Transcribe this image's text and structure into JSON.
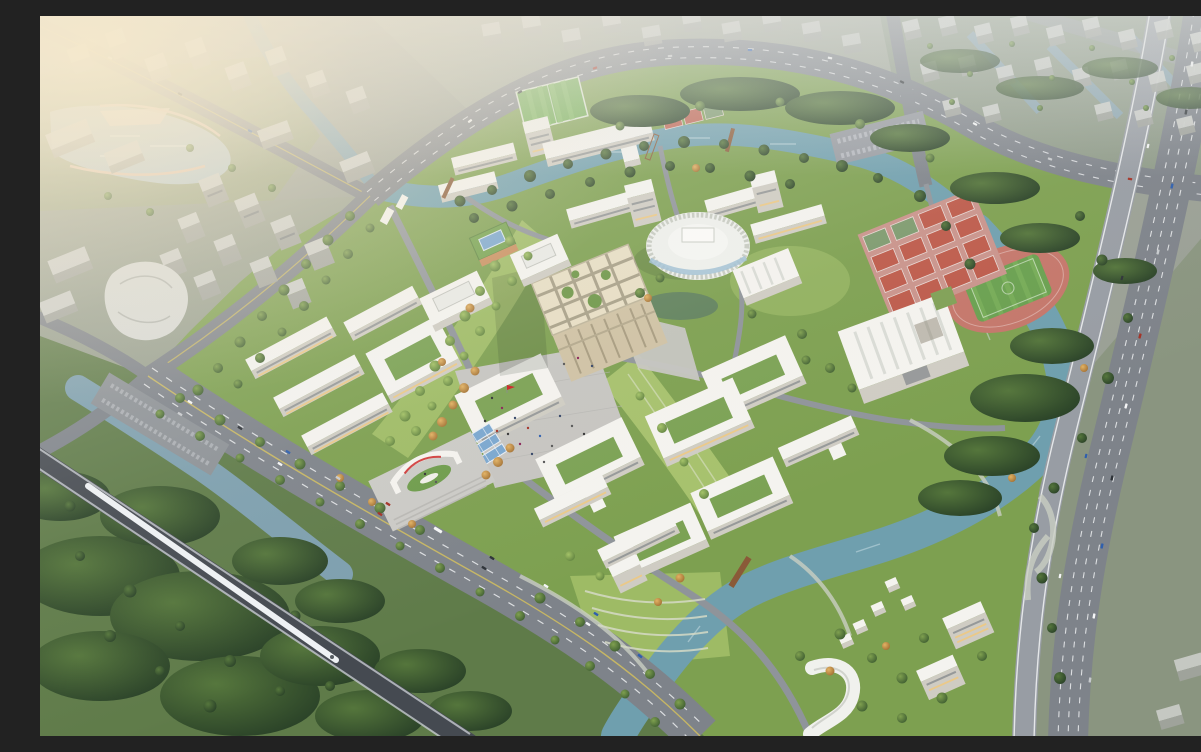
{
  "scene": {
    "type": "aerial-architectural-rendering",
    "description": "Aerial dusk rendering of a university campus master plan: a central beige library cube with rooftop garden grid and large public plaza, an oval ribbed auditorium, gymnasiums, a red running track with soccer field, pink sports courts, dormitory and teaching building clusters in white, all wrapped by a winding teal river, a tree-lined main avenue with an arched main gate, an elevated railway with a white high-speed train, a multi-lane highway on the east, and hazy residential tower districts beyond.",
    "landmarks": [
      "library-cube",
      "oval-auditorium",
      "central-plaza",
      "main-gate",
      "gymnasium",
      "small-exhibition-hall",
      "green-roof-solar-building",
      "solar-canopy",
      "running-track",
      "soccer-field",
      "sports-courts",
      "bleachers",
      "dormitory-cluster-northwest",
      "dormitory-cluster-north",
      "teaching-cluster-east",
      "teaching-cluster-south",
      "dormitory-towers-southeast",
      "cottage-houses",
      "curved-hotel-building",
      "river",
      "lake-park",
      "canals",
      "pedestrian-bridges",
      "main-avenue",
      "north-arterial-road",
      "east-highway",
      "elevated-railway",
      "high-speed-train",
      "residential-district-northeast",
      "residential-district-northwest",
      "forest",
      "red-flag",
      "crowd-on-plaza"
    ]
  },
  "palette": {
    "base-city": "#9aa095",
    "campus-green": "#7da050",
    "lawn": "#a3bf68",
    "tree-dark": "#2c452a",
    "tree-mid": "#4a6b38",
    "tree-light": "#6d9447",
    "tree-autumn": "#c89243",
    "water-river": "#6f9fae",
    "water-lake": "#b4c6cb",
    "water-canal": "#7d9fae",
    "road": "#7e838a",
    "road-light": "#989da4",
    "lane": "#eceef0",
    "plaza": "#c6c5c1",
    "bld-roof": "#f4f3ef",
    "bld-face": "#cfccc3",
    "bld-shadow": "#afaba2",
    "beige-roof": "#e7dec4",
    "beige-face": "#cfc2a4",
    "window-band": "#5d6570",
    "window-lit": "#f0c87e",
    "track-red": "#c4766a",
    "court-red": "#bd5a4a",
    "court-base": "#c9938b",
    "field-green": "#69a04f",
    "solar-blue": "#7aa7cf",
    "rail-dark": "#454a51",
    "train-white": "#eef1f4",
    "bridge-rust": "#8a5a38",
    "flag-red": "#cc2222",
    "city-roof": "#ccceca",
    "city-face": "#a2a59f",
    "haze": "#f0e8da",
    "sun-glow": "#f6e9cb"
  }
}
